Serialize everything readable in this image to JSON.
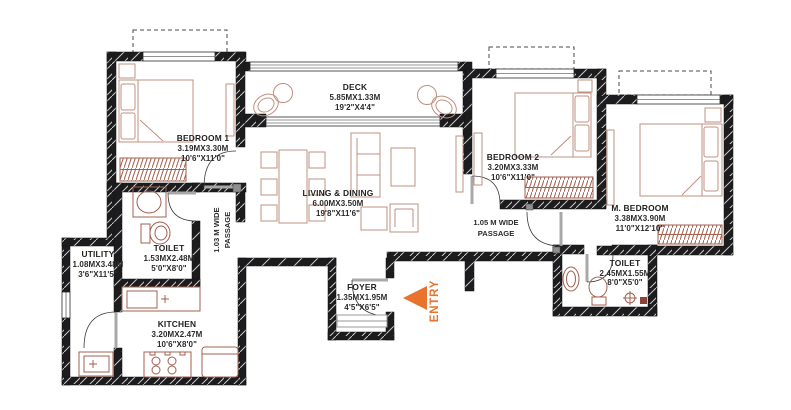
{
  "plan": {
    "colors": {
      "accent": "#e8732c",
      "wall": "#1c1c1e",
      "furniture": "#bf9080",
      "fixture": "#a2604f",
      "text": "#2b2b2b"
    },
    "rooms": [
      {
        "id": "bedroom1",
        "name": "BEDROOM 1",
        "metric": "3.19MX3.30M",
        "imperial": "10'6\"X11'0\""
      },
      {
        "id": "deck",
        "name": "DECK",
        "metric": "5.85MX1.33M",
        "imperial": "19'2\"X4'4\""
      },
      {
        "id": "living-dining",
        "name": "LIVING & DINING",
        "metric": "6.00MX3.50M",
        "imperial": "19'8\"X11'6\""
      },
      {
        "id": "bedroom2",
        "name": "BEDROOM 2",
        "metric": "3.20MX3.33M",
        "imperial": "10'6\"X11'0\""
      },
      {
        "id": "master-bedroom",
        "name": "M. BEDROOM",
        "metric": "3.38MX3.90M",
        "imperial": "11'0\"X12'10\""
      },
      {
        "id": "toilet-1",
        "name": "TOILET",
        "metric": "1.53MX2.48M",
        "imperial": "5'0\"X8'0\""
      },
      {
        "id": "utility",
        "name": "UTILITY",
        "metric": "1.08MX3.48M",
        "imperial": "3'6\"X11'5\""
      },
      {
        "id": "kitchen",
        "name": "KITCHEN",
        "metric": "3.20MX2.47M",
        "imperial": "10'6\"X8'0\""
      },
      {
        "id": "foyer",
        "name": "FOYER",
        "metric": "1.35MX1.95M",
        "imperial": "4'5\"X6'5\""
      },
      {
        "id": "toilet-2",
        "name": "TOILET",
        "metric": "2.45MX1.55M",
        "imperial": "8'0\"X5'0\""
      }
    ],
    "passages": [
      {
        "id": "passage-1",
        "line1": "1.03 M WIDE",
        "line2": "PASSAGE"
      },
      {
        "id": "passage-2",
        "line1": "1.05 M WIDE",
        "line2": "PASSAGE"
      }
    ],
    "entry": {
      "label": "ENTRY"
    }
  }
}
